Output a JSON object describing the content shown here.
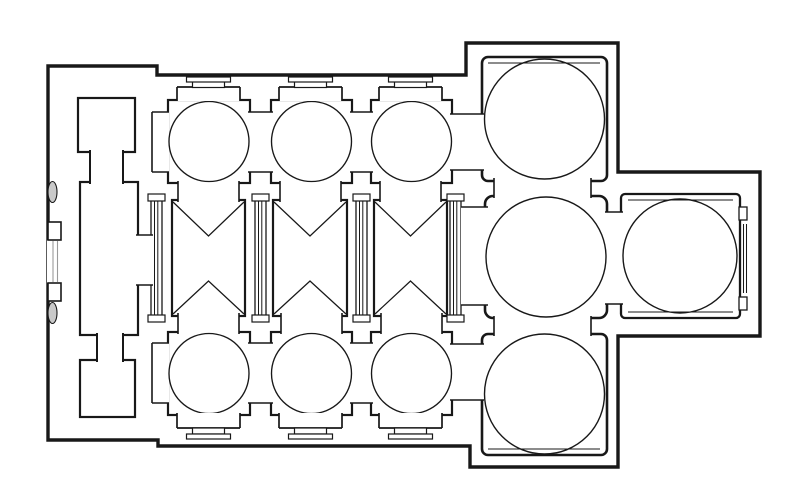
{
  "canvas": {
    "width": 800,
    "height": 488,
    "paper": "#ffffff",
    "ink": "#181818",
    "light_ink": "#9a9a9a"
  },
  "figure": {
    "type": "architectural-floor-plan",
    "subject": "line drawing of a domed church plan: west narthex with two square chambers and central hall, three-bay nave with cross-vault bow-tie marks flanked by three domed aisle bays each side, large domed crossing flanked by two large domed chambers, and a domed east apse hall"
  },
  "drawing": {
    "shapes": [
      {
        "k": "path",
        "n": "building-outline",
        "d": "M48,66 L157,66 L157,75 L466,75 L466,43 L618,43 L618,172 L760,172 L760,336 L618,336 L618,467 L470,467 L470,446 L158,446 L158,440 L48,440 Z",
        "fill": "#ffffff",
        "sw": 3.4
      },
      {
        "k": "rect",
        "n": "narthex-north-chamber",
        "x": 78,
        "y": 98,
        "w": 57,
        "h": 54,
        "sw": 2.2
      },
      {
        "k": "rect",
        "n": "narthex-hall",
        "x": 80,
        "y": 182,
        "w": 58,
        "h": 153,
        "sw": 2.2
      },
      {
        "k": "rect",
        "n": "narthex-south-chamber",
        "x": 80,
        "y": 360,
        "w": 55,
        "h": 57,
        "sw": 2.2
      },
      {
        "k": "open",
        "n": "narthex-north-neck",
        "x": 90,
        "y": 150,
        "w": 33,
        "h": 34,
        "sides": "lr",
        "sw": 2
      },
      {
        "k": "open",
        "n": "narthex-south-neck",
        "x": 97,
        "y": 333,
        "w": 26,
        "h": 29,
        "sides": "lr",
        "sw": 2
      },
      {
        "k": "rect",
        "n": "aisle-north-bay-1",
        "x": 168,
        "y": 100,
        "w": 82,
        "h": 83,
        "sw": 2.2
      },
      {
        "k": "rect",
        "n": "aisle-north-bay-2",
        "x": 271,
        "y": 100,
        "w": 81,
        "h": 83,
        "sw": 2.2
      },
      {
        "k": "rect",
        "n": "aisle-north-bay-3",
        "x": 371,
        "y": 100,
        "w": 81,
        "h": 83,
        "sw": 2.2
      },
      {
        "k": "rect",
        "n": "aisle-south-bay-1",
        "x": 168,
        "y": 332,
        "w": 82,
        "h": 83,
        "sw": 2.2
      },
      {
        "k": "rect",
        "n": "aisle-south-bay-2",
        "x": 271,
        "y": 332,
        "w": 81,
        "h": 83,
        "sw": 2.2
      },
      {
        "k": "rect",
        "n": "aisle-south-bay-3",
        "x": 371,
        "y": 332,
        "w": 81,
        "h": 83,
        "sw": 2.2
      },
      {
        "k": "rect",
        "n": "nave-bay-1",
        "x": 172,
        "y": 200,
        "w": 73,
        "h": 116,
        "sw": 2.2
      },
      {
        "k": "rect",
        "n": "nave-bay-2",
        "x": 273,
        "y": 200,
        "w": 74,
        "h": 116,
        "sw": 2.2
      },
      {
        "k": "rect",
        "n": "nave-bay-3",
        "x": 374,
        "y": 200,
        "w": 73,
        "h": 116,
        "sw": 2.2
      },
      {
        "k": "rect",
        "n": "nave-pier-strip-0",
        "x": 151,
        "y": 198,
        "w": 11,
        "h": 120,
        "sw": 1.3
      },
      {
        "k": "line",
        "n": "nave-pier-strip-0-line",
        "x1": 154.5,
        "y1": 199,
        "x2": 154.5,
        "y2": 317,
        "sw": 1
      },
      {
        "k": "line",
        "n": "nave-pier-strip-0-line",
        "x1": 157.8,
        "y1": 199,
        "x2": 157.8,
        "y2": 317,
        "sw": 1
      },
      {
        "k": "rect",
        "n": "nave-pier-strip-1",
        "x": 255,
        "y": 198,
        "w": 11,
        "h": 120,
        "sw": 1.3
      },
      {
        "k": "line",
        "n": "nave-pier-strip-1-line",
        "x1": 258.5,
        "y1": 199,
        "x2": 258.5,
        "y2": 317,
        "sw": 1
      },
      {
        "k": "line",
        "n": "nave-pier-strip-1-line",
        "x1": 261.8,
        "y1": 199,
        "x2": 261.8,
        "y2": 317,
        "sw": 1
      },
      {
        "k": "rect",
        "n": "nave-pier-strip-2",
        "x": 356,
        "y": 198,
        "w": 11,
        "h": 120,
        "sw": 1.3
      },
      {
        "k": "line",
        "n": "nave-pier-strip-2-line",
        "x1": 359.5,
        "y1": 199,
        "x2": 359.5,
        "y2": 317,
        "sw": 1
      },
      {
        "k": "line",
        "n": "nave-pier-strip-2-line",
        "x1": 362.8,
        "y1": 199,
        "x2": 362.8,
        "y2": 317,
        "sw": 1
      },
      {
        "k": "rect",
        "n": "nave-pier-strip-3",
        "x": 450,
        "y": 198,
        "w": 11,
        "h": 120,
        "sw": 1.3
      },
      {
        "k": "line",
        "n": "nave-pier-strip-3-line",
        "x1": 453.5,
        "y1": 199,
        "x2": 453.5,
        "y2": 317,
        "sw": 1
      },
      {
        "k": "line",
        "n": "nave-pier-strip-3-line",
        "x1": 456.8,
        "y1": 199,
        "x2": 456.8,
        "y2": 317,
        "sw": 1
      },
      {
        "k": "rect",
        "n": "pier-cap",
        "x": 148,
        "y": 194,
        "w": 17,
        "h": 7,
        "sw": 1.2
      },
      {
        "k": "rect",
        "n": "pier-cap",
        "x": 148,
        "y": 315,
        "w": 17,
        "h": 7,
        "sw": 1.2
      },
      {
        "k": "rect",
        "n": "pier-cap",
        "x": 252,
        "y": 194,
        "w": 17,
        "h": 7,
        "sw": 1.2
      },
      {
        "k": "rect",
        "n": "pier-cap",
        "x": 252,
        "y": 315,
        "w": 17,
        "h": 7,
        "sw": 1.2
      },
      {
        "k": "rect",
        "n": "pier-cap",
        "x": 353,
        "y": 194,
        "w": 17,
        "h": 7,
        "sw": 1.2
      },
      {
        "k": "rect",
        "n": "pier-cap",
        "x": 353,
        "y": 315,
        "w": 17,
        "h": 7,
        "sw": 1.2
      },
      {
        "k": "rect",
        "n": "pier-cap",
        "x": 447,
        "y": 194,
        "w": 17,
        "h": 7,
        "sw": 1.2
      },
      {
        "k": "rect",
        "n": "pier-cap",
        "x": 447,
        "y": 315,
        "w": 17,
        "h": 7,
        "sw": 1.2
      },
      {
        "k": "rect",
        "n": "northeast-domed-chamber",
        "x": 482,
        "y": 57,
        "w": 125,
        "h": 124,
        "rx": 6,
        "sw": 2.6
      },
      {
        "k": "line",
        "n": "northeast-chamber-inner-line",
        "x1": 488,
        "y1": 63,
        "x2": 600,
        "y2": 63,
        "sw": 1.1
      },
      {
        "k": "rect",
        "n": "crossing-domed-hall",
        "x": 485,
        "y": 196,
        "w": 122,
        "h": 122,
        "rx": 8,
        "sw": 2.6
      },
      {
        "k": "rect",
        "n": "southeast-domed-chamber",
        "x": 482,
        "y": 334,
        "w": 125,
        "h": 121,
        "rx": 6,
        "sw": 2.6
      },
      {
        "k": "line",
        "n": "southeast-chamber-inner-line",
        "x1": 488,
        "y1": 449,
        "x2": 600,
        "y2": 449,
        "sw": 1.1
      },
      {
        "k": "rect",
        "n": "apse-domed-hall",
        "x": 621,
        "y": 194,
        "w": 119,
        "h": 124,
        "rx": 4,
        "sw": 2.3
      },
      {
        "k": "line",
        "n": "apse-inner-line-top",
        "x1": 628,
        "y1": 200,
        "x2": 733,
        "y2": 200,
        "sw": 1.1
      },
      {
        "k": "line",
        "n": "apse-inner-line-bottom",
        "x1": 628,
        "y1": 312,
        "x2": 733,
        "y2": 312,
        "sw": 1.1
      },
      {
        "k": "open",
        "n": "doorway-aisle-north-to-narthex-niche",
        "x": 152,
        "y": 112,
        "w": 17,
        "h": 60,
        "sides": "tbl",
        "sw": 1.6
      },
      {
        "k": "open",
        "n": "doorway-aisle-north-1-2",
        "x": 248,
        "y": 112,
        "w": 25,
        "h": 60,
        "sides": "tb",
        "sw": 1.6
      },
      {
        "k": "open",
        "n": "doorway-aisle-north-2-3",
        "x": 350,
        "y": 112,
        "w": 23,
        "h": 60,
        "sides": "tb",
        "sw": 1.6
      },
      {
        "k": "open",
        "n": "doorway-aisle-north-3-to-northeast",
        "x": 450,
        "y": 114,
        "w": 34,
        "h": 56,
        "sides": "tb",
        "sw": 1.6
      },
      {
        "k": "open",
        "n": "doorway-aisle-south-to-narthex-niche",
        "x": 152,
        "y": 343,
        "w": 17,
        "h": 60,
        "sides": "tbl",
        "sw": 1.6
      },
      {
        "k": "open",
        "n": "doorway-aisle-south-1-2",
        "x": 248,
        "y": 343,
        "w": 25,
        "h": 60,
        "sides": "tb",
        "sw": 1.6
      },
      {
        "k": "open",
        "n": "doorway-aisle-south-2-3",
        "x": 350,
        "y": 343,
        "w": 23,
        "h": 60,
        "sides": "tb",
        "sw": 1.6
      },
      {
        "k": "open",
        "n": "doorway-aisle-south-3-to-southeast",
        "x": 450,
        "y": 344,
        "w": 34,
        "h": 56,
        "sides": "tb",
        "sw": 1.6
      },
      {
        "k": "open",
        "n": "arch-nave1-to-north-aisle",
        "x": 178,
        "y": 181,
        "w": 61,
        "h": 21,
        "sides": "lr",
        "sw": 1.6
      },
      {
        "k": "open",
        "n": "arch-nave2-to-north-aisle",
        "x": 280,
        "y": 181,
        "w": 61,
        "h": 21,
        "sides": "lr",
        "sw": 1.6
      },
      {
        "k": "open",
        "n": "arch-nave3-to-north-aisle",
        "x": 380,
        "y": 181,
        "w": 61,
        "h": 21,
        "sides": "lr",
        "sw": 1.6
      },
      {
        "k": "open",
        "n": "arch-nave1-to-south-aisle",
        "x": 178,
        "y": 313,
        "w": 61,
        "h": 21,
        "sides": "lr",
        "sw": 1.6
      },
      {
        "k": "open",
        "n": "arch-nave2-to-south-aisle",
        "x": 281,
        "y": 313,
        "w": 61,
        "h": 21,
        "sides": "lr",
        "sw": 1.6
      },
      {
        "k": "open",
        "n": "arch-nave3-to-south-aisle",
        "x": 381,
        "y": 313,
        "w": 61,
        "h": 21,
        "sides": "lr",
        "sw": 1.6
      },
      {
        "k": "open",
        "n": "doorway-hall-to-nave",
        "x": 136,
        "y": 235,
        "w": 17,
        "h": 50,
        "sides": "tb",
        "sw": 1.6
      },
      {
        "k": "open",
        "n": "arch-northeast-to-crossing",
        "x": 494,
        "y": 178,
        "w": 97,
        "h": 20,
        "sides": "lr",
        "sw": 1.6
      },
      {
        "k": "open",
        "n": "arch-crossing-to-southeast",
        "x": 494,
        "y": 316,
        "w": 97,
        "h": 20,
        "sides": "lr",
        "sw": 1.6
      },
      {
        "k": "open",
        "n": "arch-crossing-to-apse",
        "x": 605,
        "y": 212,
        "w": 18,
        "h": 92,
        "sides": "tb",
        "sw": 1.6
      },
      {
        "k": "open",
        "n": "arch-nave-to-crossing",
        "x": 461,
        "y": 207,
        "w": 27,
        "h": 98,
        "sides": "tb",
        "sw": 1.6
      },
      {
        "k": "circle",
        "n": "dome-circle-aisle-north-1",
        "cx": 209,
        "cy": 141.5,
        "r": 40,
        "sw": 1.35
      },
      {
        "k": "circle",
        "n": "dome-circle-aisle-north-2",
        "cx": 311.5,
        "cy": 141.5,
        "r": 40,
        "sw": 1.35
      },
      {
        "k": "circle",
        "n": "dome-circle-aisle-north-3",
        "cx": 411.5,
        "cy": 141.5,
        "r": 40,
        "sw": 1.35
      },
      {
        "k": "circle",
        "n": "dome-circle-aisle-south-1",
        "cx": 209,
        "cy": 373.5,
        "r": 40,
        "sw": 1.35
      },
      {
        "k": "circle",
        "n": "dome-circle-aisle-south-2",
        "cx": 311.5,
        "cy": 373.5,
        "r": 40,
        "sw": 1.35
      },
      {
        "k": "circle",
        "n": "dome-circle-aisle-south-3",
        "cx": 411.5,
        "cy": 373.5,
        "r": 40,
        "sw": 1.35
      },
      {
        "k": "circle",
        "n": "dome-circle-northeast",
        "cx": 544.5,
        "cy": 119,
        "r": 60,
        "sw": 1.4
      },
      {
        "k": "circle",
        "n": "dome-circle-crossing",
        "cx": 546,
        "cy": 257,
        "r": 60,
        "sw": 1.4
      },
      {
        "k": "circle",
        "n": "dome-circle-southeast",
        "cx": 544.5,
        "cy": 394,
        "r": 60,
        "sw": 1.4
      },
      {
        "k": "circle",
        "n": "dome-circle-apse",
        "cx": 680,
        "cy": 256,
        "r": 57,
        "sw": 1.4
      },
      {
        "k": "poly",
        "n": "cross-vault-mark-nave1-top",
        "pts": "173,202 208.5,236 244,202",
        "sw": 1.25
      },
      {
        "k": "poly",
        "n": "cross-vault-mark-nave1-bottom",
        "pts": "173,314 208.5,281 244,314",
        "sw": 1.25
      },
      {
        "k": "poly",
        "n": "cross-vault-mark-nave2-top",
        "pts": "274,202 310,236 346,202",
        "sw": 1.25
      },
      {
        "k": "poly",
        "n": "cross-vault-mark-nave2-bottom",
        "pts": "274,314 310,281 346,314",
        "sw": 1.25
      },
      {
        "k": "poly",
        "n": "cross-vault-mark-nave3-top",
        "pts": "375,202 410.5,236 446,202",
        "sw": 1.25
      },
      {
        "k": "poly",
        "n": "cross-vault-mark-nave3-bottom",
        "pts": "375,314 410.5,281 446,314",
        "sw": 1.25
      },
      {
        "k": "open",
        "n": "portal-niche-north-1",
        "x": 177,
        "y": 87,
        "w": 63,
        "h": 14,
        "sides": "tlr",
        "sw": 1.7
      },
      {
        "k": "rect",
        "n": "portal-molding",
        "x": 192.5,
        "y": 81.5,
        "w": 32,
        "h": 6,
        "sw": 1.2
      },
      {
        "k": "rect",
        "n": "portal-molding",
        "x": 186.5,
        "y": 77,
        "w": 44,
        "h": 5,
        "sw": 1.2
      },
      {
        "k": "open",
        "n": "portal-niche-north-2",
        "x": 279,
        "y": 87,
        "w": 63,
        "h": 14,
        "sides": "tlr",
        "sw": 1.7
      },
      {
        "k": "rect",
        "n": "portal-molding",
        "x": 294.5,
        "y": 81.5,
        "w": 32,
        "h": 6,
        "sw": 1.2
      },
      {
        "k": "rect",
        "n": "portal-molding",
        "x": 288.5,
        "y": 77,
        "w": 44,
        "h": 5,
        "sw": 1.2
      },
      {
        "k": "open",
        "n": "portal-niche-north-3",
        "x": 379,
        "y": 87,
        "w": 63,
        "h": 14,
        "sides": "tlr",
        "sw": 1.7
      },
      {
        "k": "rect",
        "n": "portal-molding",
        "x": 394.5,
        "y": 81.5,
        "w": 32,
        "h": 6,
        "sw": 1.2
      },
      {
        "k": "rect",
        "n": "portal-molding",
        "x": 388.5,
        "y": 77,
        "w": 44,
        "h": 5,
        "sw": 1.2
      },
      {
        "k": "open",
        "n": "portal-niche-south-1",
        "x": 177,
        "y": 413,
        "w": 63,
        "h": 15,
        "sides": "blr",
        "sw": 1.7
      },
      {
        "k": "rect",
        "n": "portal-molding",
        "x": 192.5,
        "y": 428,
        "w": 32,
        "h": 6,
        "sw": 1.2
      },
      {
        "k": "rect",
        "n": "portal-molding",
        "x": 186.5,
        "y": 434,
        "w": 44,
        "h": 5,
        "sw": 1.2
      },
      {
        "k": "open",
        "n": "portal-niche-south-2",
        "x": 279,
        "y": 413,
        "w": 63,
        "h": 15,
        "sides": "blr",
        "sw": 1.7
      },
      {
        "k": "rect",
        "n": "portal-molding",
        "x": 294.5,
        "y": 428,
        "w": 32,
        "h": 6,
        "sw": 1.2
      },
      {
        "k": "rect",
        "n": "portal-molding",
        "x": 288.5,
        "y": 434,
        "w": 44,
        "h": 5,
        "sw": 1.2
      },
      {
        "k": "open",
        "n": "portal-niche-south-3",
        "x": 379,
        "y": 413,
        "w": 63,
        "h": 15,
        "sides": "blr",
        "sw": 1.7
      },
      {
        "k": "rect",
        "n": "portal-molding",
        "x": 394.5,
        "y": 428,
        "w": 32,
        "h": 6,
        "sw": 1.2
      },
      {
        "k": "rect",
        "n": "portal-molding",
        "x": 388.5,
        "y": 434,
        "w": 44,
        "h": 5,
        "sw": 1.2
      },
      {
        "k": "rect",
        "n": "apse-east-pilaster-north",
        "x": 739,
        "y": 207,
        "w": 8,
        "h": 13,
        "sw": 1.3
      },
      {
        "k": "rect",
        "n": "apse-east-pilaster-south",
        "x": 739,
        "y": 297,
        "w": 8,
        "h": 13,
        "sw": 1.3
      },
      {
        "k": "line",
        "n": "apse-east-recess-line",
        "x1": 743.5,
        "y1": 224,
        "x2": 743.5,
        "y2": 293,
        "sw": 1.05
      },
      {
        "k": "line",
        "n": "apse-east-recess-line",
        "x1": 746.5,
        "y1": 224,
        "x2": 746.5,
        "y2": 293,
        "sw": 1.05
      },
      {
        "k": "open",
        "n": "west-entrance-gap",
        "x": 47,
        "y": 240,
        "w": 14,
        "h": 43,
        "sides": "",
        "sw": 1
      },
      {
        "k": "line",
        "n": "west-entrance-threshold",
        "x1": 53,
        "y1": 241,
        "x2": 53,
        "y2": 282,
        "sw": 1.1,
        "c": "#9a9a9a"
      },
      {
        "k": "line",
        "n": "west-entrance-threshold",
        "x1": 57.5,
        "y1": 241,
        "x2": 57.5,
        "y2": 282,
        "sw": 1.1,
        "c": "#9a9a9a"
      },
      {
        "k": "rect",
        "n": "west-portal-jamb-north",
        "x": 48,
        "y": 222,
        "w": 13,
        "h": 18,
        "sw": 1.6
      },
      {
        "k": "rect",
        "n": "west-portal-jamb-south",
        "x": 48,
        "y": 283,
        "w": 13,
        "h": 18,
        "sw": 1.6
      },
      {
        "k": "ellipse",
        "n": "west-facade-column-north",
        "cx": 52.5,
        "cy": 192,
        "rx": 4.5,
        "ry": 10.5,
        "fill": "#c9c9c9",
        "sw": 1.1
      },
      {
        "k": "ellipse",
        "n": "west-facade-column-south",
        "cx": 52.5,
        "cy": 313,
        "rx": 4.5,
        "ry": 10.5,
        "fill": "#c9c9c9",
        "sw": 1.1
      }
    ]
  }
}
